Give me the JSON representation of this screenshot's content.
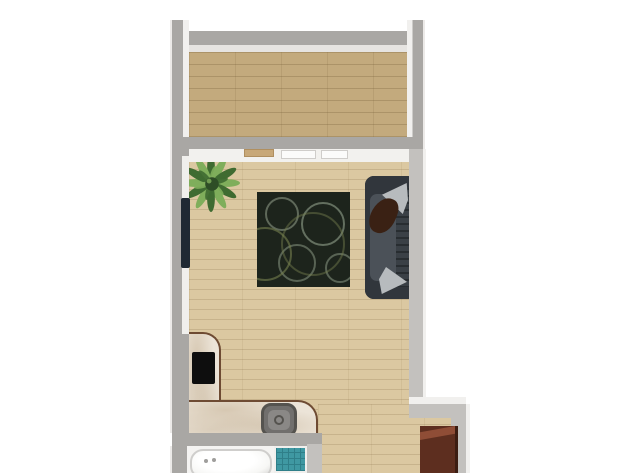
{
  "meta": {
    "title": "Top-down 2D floor plan rendering of a studio apartment",
    "canvas_width": 640,
    "canvas_height": 473
  },
  "palette": {
    "bg": "#ffffff",
    "wall": "#a9a7a4",
    "wall_light": "#c3c1be",
    "wall_highlight": "#f1f0ee",
    "balcony_floor": "#c3aa7d",
    "living_floor": "#dbc8a1",
    "floor_white": "#f4f3f1",
    "rug": "#1d241c",
    "rug_swirl_light": "#93a18c",
    "rug_swirl_olive": "#77804f",
    "sofa_frame": "#31363c",
    "sofa_seat": "#4b5158",
    "sofa_back": "#3a4046",
    "pillow": "#b7bbbe",
    "throw": "#3a2114",
    "counter": "#ece4d8",
    "counter_edge": "#6e4b33",
    "cooktop": "#0e0e0e",
    "sink_outer": "#55534f",
    "sink_body": "#716f6d",
    "sink_inner": "#8a8886",
    "tub": "#f7f7f5",
    "tub_shadow": "#cfcecc",
    "tile": "#3f98a2",
    "tile_line": "#2f7f89",
    "cabinet_front": "#5d2e1f",
    "cabinet_top": "#8f4d36",
    "cabinet_side": "#3c1d12",
    "plant_dark": "#3f6b31",
    "plant_light": "#7fae5b",
    "plant_center": "#2e4d26",
    "tv": "#1f2933",
    "shelf": "#c8a878",
    "window_frame": "#cfcdca"
  },
  "scene": {
    "rooms": [
      {
        "id": "balcony"
      },
      {
        "id": "living-room"
      },
      {
        "id": "kitchenette"
      },
      {
        "id": "bathroom"
      },
      {
        "id": "entry-hall"
      }
    ],
    "objects": [
      {
        "id": "potted-plant",
        "room": "living-room"
      },
      {
        "id": "area-rug",
        "room": "living-room"
      },
      {
        "id": "sofa",
        "room": "living-room"
      },
      {
        "id": "sofa-pillows",
        "room": "living-room"
      },
      {
        "id": "sofa-throw-blanket",
        "room": "living-room"
      },
      {
        "id": "wall-mounted-tv",
        "room": "living-room"
      },
      {
        "id": "wall-shelf",
        "room": "living-room"
      },
      {
        "id": "windows",
        "room": "living-room"
      },
      {
        "id": "l-shaped-counter",
        "room": "kitchenette"
      },
      {
        "id": "cooktop",
        "room": "kitchenette"
      },
      {
        "id": "sink",
        "room": "kitchenette"
      },
      {
        "id": "bathtub",
        "room": "bathroom"
      },
      {
        "id": "shower-floor-tile",
        "room": "bathroom"
      },
      {
        "id": "cabinet",
        "room": "entry-hall"
      }
    ]
  }
}
